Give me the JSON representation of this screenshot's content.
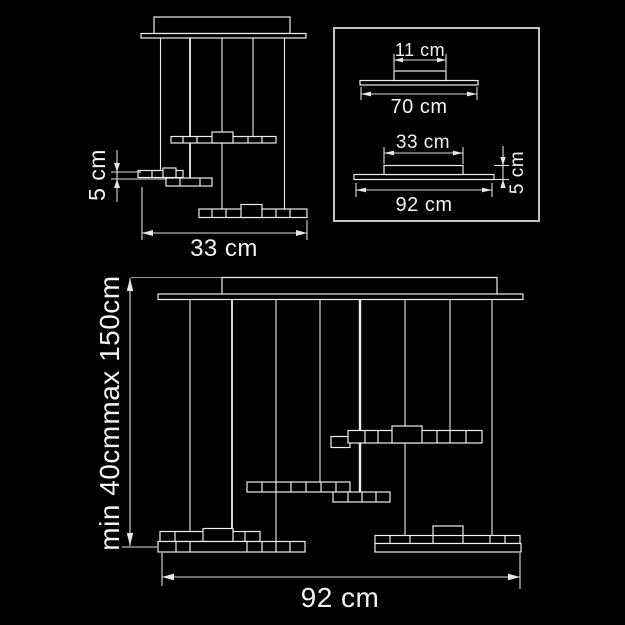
{
  "colors": {
    "background": "#000000",
    "line": "#ededed",
    "dimension_line": "#dedede",
    "text": "#f3f3f3",
    "inset_border": "#c4c4c4"
  },
  "small_view": {
    "step_height": "5 cm",
    "width": "33 cm"
  },
  "inset": {
    "variant_70": {
      "canopy_width": "11 cm",
      "base_width": "70 cm"
    },
    "variant_92": {
      "canopy_width": "33 cm",
      "base_width": "92 cm",
      "fixture_height": "5 cm"
    }
  },
  "large_view": {
    "min_drop": "min 40cm",
    "max_drop": "max 150cm",
    "width": "92 cm"
  }
}
